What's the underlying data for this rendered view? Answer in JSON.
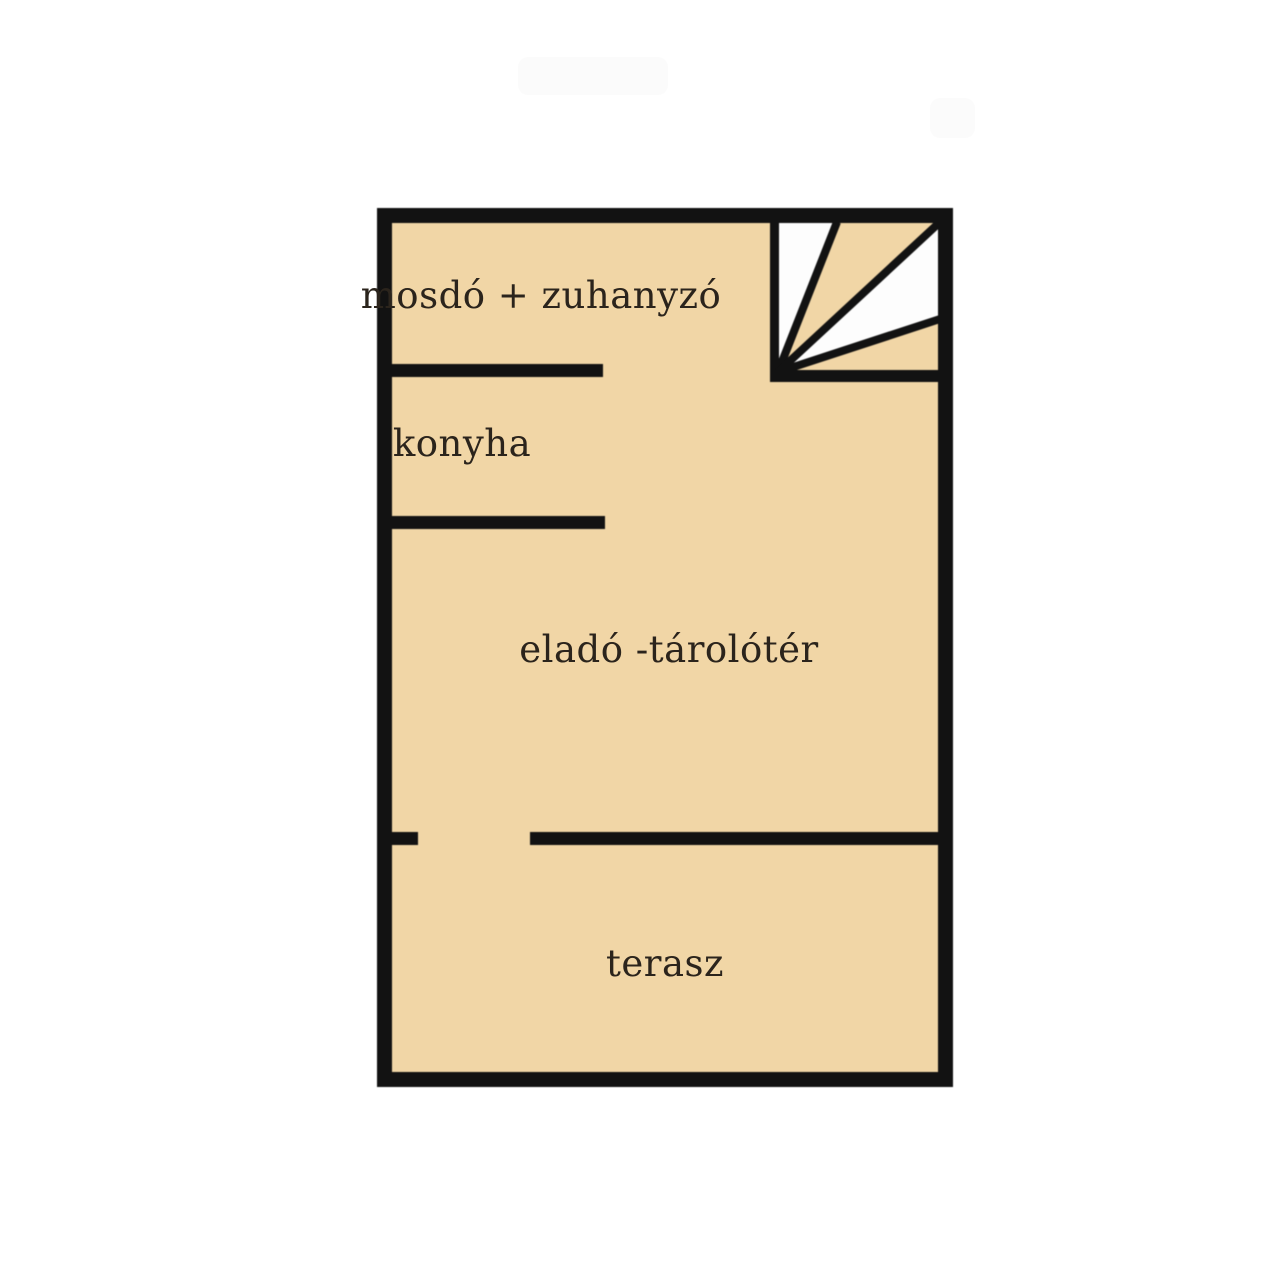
{
  "plan": {
    "rooms": [
      {
        "id": "mosdo-zuhanyzo",
        "label": "mosdó + zuhanyzó"
      },
      {
        "id": "konyha",
        "label": "konyha"
      },
      {
        "id": "elado-taroloter",
        "label": "eladó -tárolótér"
      },
      {
        "id": "terasz",
        "label": "terasz"
      }
    ],
    "colors": {
      "background": "#ffffff",
      "floor": "#f1d6a6",
      "wall": "#121212",
      "stairwhite": "#fdfdfd",
      "text": "#2b241c"
    }
  }
}
